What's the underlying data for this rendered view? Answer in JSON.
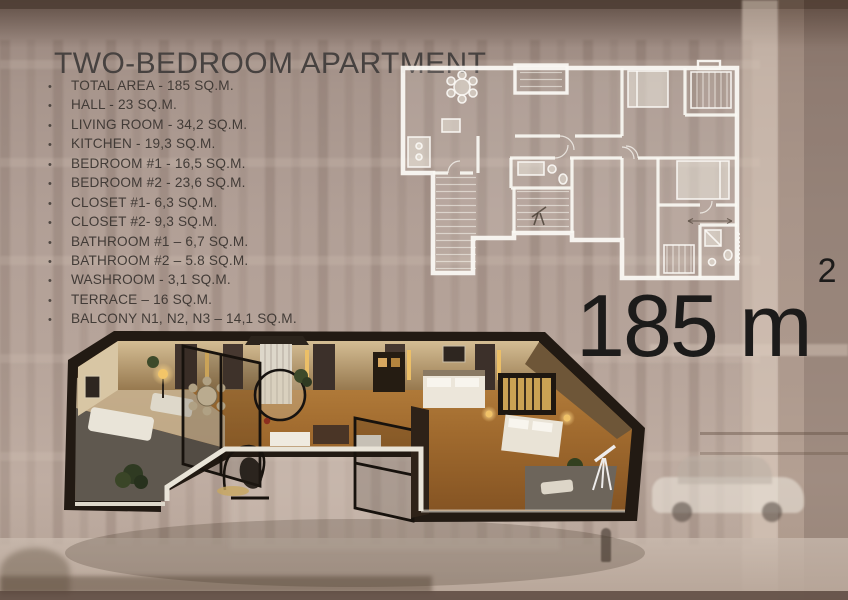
{
  "slide": {
    "title": "TWO-BEDROOM APARTMENT",
    "specs": {
      "bullet": "•",
      "items": [
        "TOTAL AREA - 185 SQ.M.",
        "HALL - 23 SQ.M.",
        "LIVING ROOM - 34,2 SQ.M.",
        "KITCHEN - 19,3 SQ.M.",
        "BEDROOM #1 - 16,5 SQ.M.",
        "BEDROOM #2 - 23,6 SQ.M.",
        "CLOSET #1- 6,3 SQ.M.",
        "CLOSET #2- 9,3 SQ.M.",
        "BATHROOM #1 – 6,7 SQ.M.",
        "BATHROOM #2 – 5.8 SQ.M.",
        "WASHROOM - 3,1 SQ.M.",
        "TERRACE – 16 SQ.M.",
        "BALCONY N1, N2, N3 – 14,1 SQ.M."
      ]
    },
    "area_headline": {
      "value": "185 m",
      "superscript": "2"
    },
    "colors": {
      "background": "#b19f96",
      "title_text": "#474240",
      "list_text": "#3d3733",
      "headline_text": "#1c1b1a",
      "plan_walls": "#f8f6f1",
      "render_wood_floor": "#a06a2e",
      "render_outer_wall": "#221a13"
    }
  }
}
